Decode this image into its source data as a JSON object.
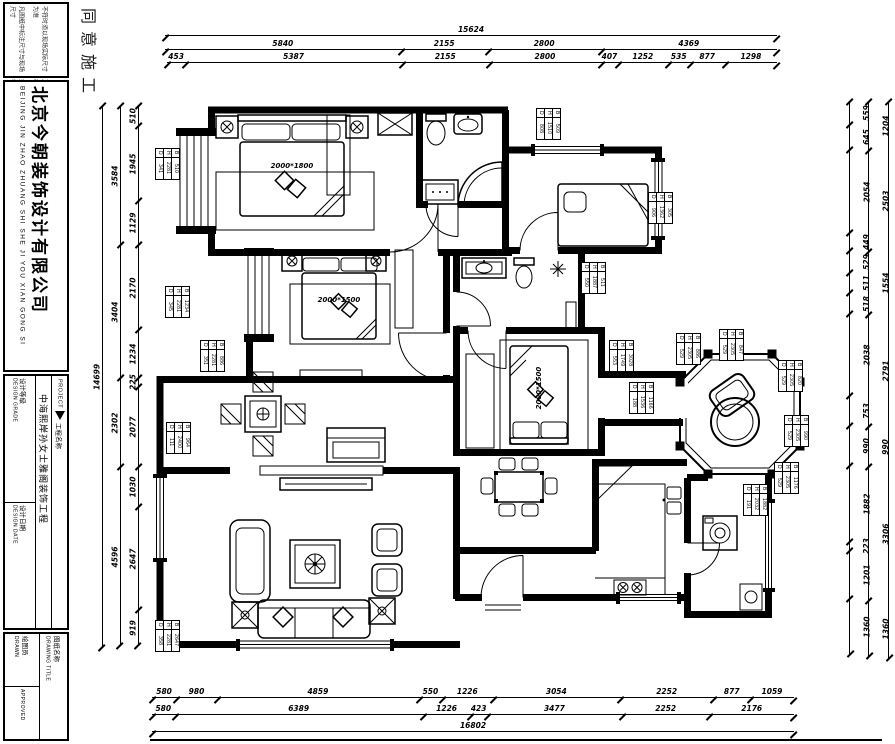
{
  "stamp": "同意施工",
  "title_block": {
    "note_lines": [
      "凡图纸中标注尺寸与现场尺寸",
      "不符时须以现场实际尺寸为准",
      "如发现图中所示数字之差错请",
      "及时与设计师联系图纸版权归本公司"
    ],
    "company_cn": "北京今朝装饰设计有限公司",
    "company_en": "BEIJING JIN ZHAO ZHUANG SHI SHE JI YOU XIAN GONG SI",
    "project_label_en": "PROJECT",
    "project_label_cn": "工程名称",
    "project_name": "中海熙岸孙女士雅阁装饰工程",
    "design_grade_en": "DESIGN GRADE",
    "design_grade_cn": "设计等级",
    "design_date_en": "DESIGN DATE",
    "design_date_cn": "设计日期",
    "drawn_en": "DRAWN",
    "drawn_cn": "绘图员",
    "approved_en": "APPROVED",
    "drawing_title_en": "DRAWING TITLE",
    "drawing_title_cn": "图纸名称"
  },
  "plan": {
    "bed_master_label": "2000*1800",
    "bed_second_label": "2000*1500",
    "bed_third_label": "2000*1500"
  },
  "dimensions": {
    "top": {
      "row1": [
        15624
      ],
      "row2": [
        5840,
        2155,
        2800,
        4369
      ],
      "row3": [
        453,
        5387,
        2155,
        2800,
        407,
        1252,
        535,
        877,
        1298
      ]
    },
    "bottom": {
      "row1": [
        580,
        980,
        4859,
        550,
        1226,
        3054,
        2252,
        877,
        1059
      ],
      "row2": [
        580,
        6389,
        1226,
        423,
        3477,
        2252,
        2176
      ],
      "row3": [
        16802
      ]
    },
    "left": {
      "outer": [
        14699
      ],
      "mid": [
        3584,
        3404,
        2302,
        4596
      ],
      "inner": [
        510,
        1945,
        1129,
        2170,
        1234,
        225,
        2077,
        1030,
        2647,
        919
      ]
    },
    "right": {
      "inner": [
        559,
        645,
        2054,
        449,
        529,
        511,
        518,
        2038,
        753,
        990,
        1882,
        223,
        1201,
        1360
      ],
      "mid": [
        1204,
        2503,
        1554,
        2791,
        990,
        3306,
        1360
      ],
      "outer": [
        14707
      ]
    }
  },
  "tags": {
    "letters": [
      "D",
      "H",
      "B"
    ],
    "items": [
      {
        "x": 155,
        "y": 148,
        "values": [
          "341",
          "2281",
          "510"
        ]
      },
      {
        "x": 165,
        "y": 286,
        "values": [
          "345",
          "2281",
          "1234"
        ]
      },
      {
        "x": 200,
        "y": 340,
        "values": [
          "351",
          "2281",
          "886"
        ]
      },
      {
        "x": 166,
        "y": 422,
        "values": [
          "111",
          "2400",
          "964"
        ]
      },
      {
        "x": 155,
        "y": 620,
        "values": [
          "358",
          "2281",
          "2647"
        ]
      },
      {
        "x": 536,
        "y": 108,
        "values": [
          "808",
          "1510",
          "509"
        ]
      },
      {
        "x": 648,
        "y": 192,
        "values": [
          "906",
          "1362",
          "305"
        ]
      },
      {
        "x": 581,
        "y": 262,
        "values": [
          "550",
          "1887",
          "511"
        ]
      },
      {
        "x": 609,
        "y": 340,
        "values": [
          "553",
          "1749",
          "3028"
        ]
      },
      {
        "x": 629,
        "y": 382,
        "values": [
          "188",
          "1536",
          "1166"
        ]
      },
      {
        "x": 676,
        "y": 333,
        "values": [
          "529",
          "2305",
          "886"
        ]
      },
      {
        "x": 719,
        "y": 329,
        "values": [
          "529",
          "2305",
          "847"
        ]
      },
      {
        "x": 778,
        "y": 360,
        "values": [
          "529",
          "2305",
          "820"
        ]
      },
      {
        "x": 784,
        "y": 415,
        "values": [
          "529",
          "2305",
          "990"
        ]
      },
      {
        "x": 774,
        "y": 462,
        "values": [
          "529",
          "2305",
          "1176"
        ]
      },
      {
        "x": 743,
        "y": 484,
        "values": [
          "191",
          "2032",
          "1882"
        ]
      }
    ]
  }
}
